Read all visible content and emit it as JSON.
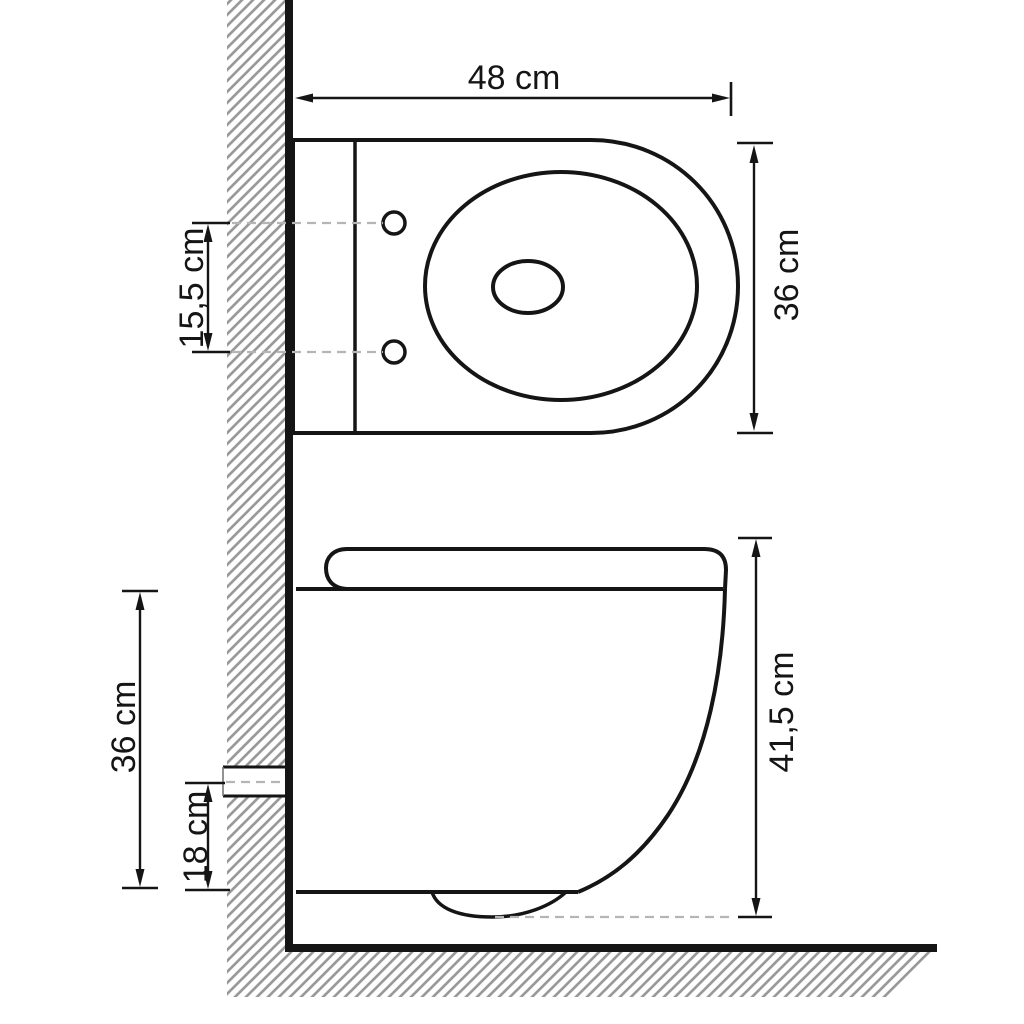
{
  "page": {
    "background": "#ffffff"
  },
  "diagram": {
    "type": "technical-dimension-drawing",
    "subject": "wall-hung toilet, top view and side view with wall and floor hatching",
    "unit": "cm",
    "colors": {
      "line": "#151515",
      "hatch": "#999999",
      "dashed_line": "#b5b5b5",
      "background": "#ffffff"
    },
    "top_view": {
      "dims": {
        "width": {
          "label": "48 cm",
          "value": 48
        },
        "depth": {
          "label": "36 cm",
          "value": 36
        },
        "mount_hole_spacing": {
          "label": "15,5 cm",
          "value": 15.5
        }
      }
    },
    "side_view": {
      "dims": {
        "total_height": {
          "label": "41,5 cm",
          "value": 41.5
        },
        "body_height": {
          "label": "36 cm",
          "value": 36
        },
        "outlet_height": {
          "label": "18 cm",
          "value": 18
        }
      }
    }
  }
}
